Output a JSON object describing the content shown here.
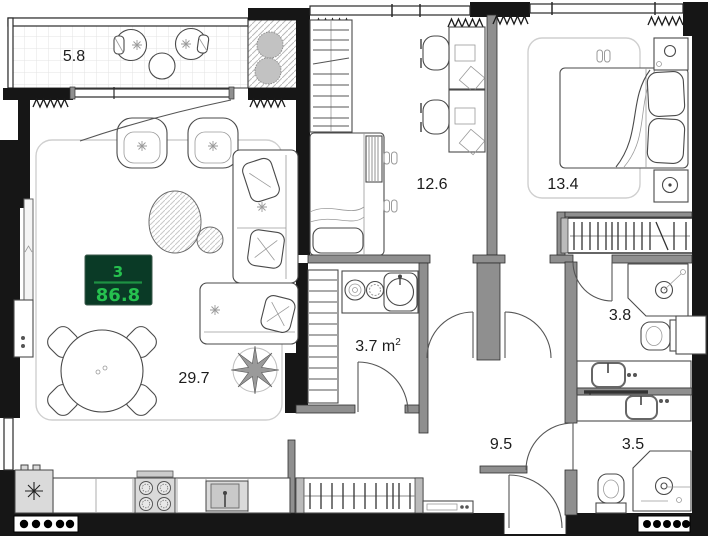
{
  "floorplan": {
    "badge": {
      "rooms_count": "3",
      "total_area": "86.8",
      "bg_color": "#0a3a26",
      "text_color": "#26c14f",
      "line_color": "#1e9143"
    },
    "rooms": {
      "balcony": {
        "area": "5.8"
      },
      "living_kitchen": {
        "area": "29.7"
      },
      "office": {
        "area": "12.6"
      },
      "bedroom": {
        "area": "13.4"
      },
      "bathroom_small": {
        "area_value": "3.7",
        "area_unit": " m",
        "area_sup": "2"
      },
      "bathroom_master": {
        "area": "3.8"
      },
      "hallway": {
        "area": "9.5"
      },
      "bathroom_guest": {
        "area": "3.5"
      }
    }
  }
}
